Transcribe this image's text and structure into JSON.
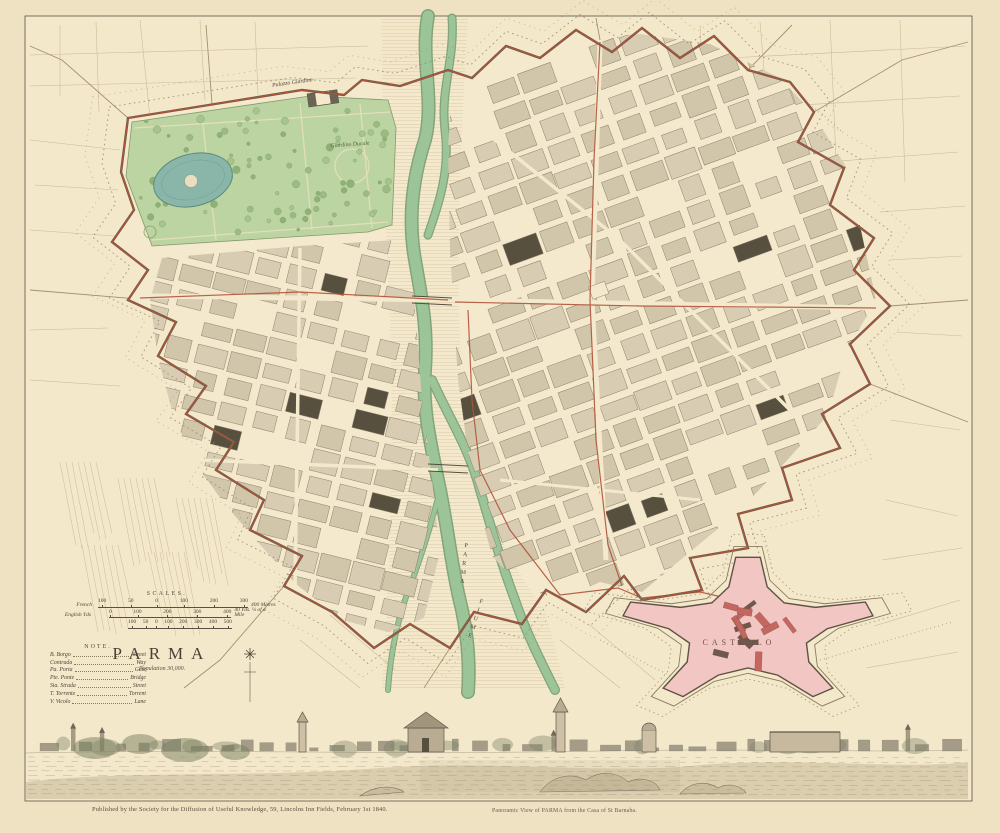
{
  "artwork": {
    "title": "PARMA",
    "subtitle": "Population 30,000.",
    "scales": {
      "heading": "SCALES.",
      "rows": [
        {
          "label": "French",
          "numbers": [
            "100",
            "50",
            "0",
            "100",
            "200",
            "300"
          ],
          "end": "400 Mètres"
        },
        {
          "label": "English Yds",
          "numbers": [
            "0",
            "100",
            "200",
            "300",
            "400"
          ],
          "end": "40 Yds. ¼ of a Mile"
        },
        {
          "label": "",
          "numbers": [
            "100",
            "50",
            "0",
            "100",
            "200",
            "300",
            "400",
            "500"
          ],
          "end": ""
        }
      ]
    },
    "note": {
      "heading": "NOTE.",
      "entries": [
        {
          "abbr": "B. Borgo",
          "meaning": "Street"
        },
        {
          "abbr": "Contrada",
          "meaning": "Way"
        },
        {
          "abbr": "Pa. Porta",
          "meaning": "Gate"
        },
        {
          "abbr": "Pte. Ponte",
          "meaning": "Bridge"
        },
        {
          "abbr": "Sta. Strada",
          "meaning": "Street"
        },
        {
          "abbr": "T. Torrente",
          "meaning": "Torrent"
        },
        {
          "abbr": "V. Vicolo",
          "meaning": "Lane"
        }
      ]
    },
    "map_labels": {
      "palazzo_giardino": "Palazzo Giardino",
      "giardino_ducale": "Giardino Ducale",
      "castello": "CASTELLO",
      "river_word_upper": "PARMA",
      "river_word_lower": "FIUME"
    },
    "footer": {
      "imprint": "Published by the Society for the Diffusion of Useful Knowledge, 59, Lincolns Inn Fields, February 1st 1840.",
      "view_caption": "Panoramic View of PARMA from the Casa of St Barnaba."
    },
    "colors": {
      "paper": "#f3e6c6",
      "wall_red": "#b0543a",
      "park_green": "#bcd4a1",
      "pond_teal": "#87b5a7",
      "river_green": "#9cc499",
      "block_tan": "#d7cbb2",
      "building_dark": "#57503f",
      "citadel_pink": "#f2c6c2",
      "ink": "#4e443a"
    }
  }
}
